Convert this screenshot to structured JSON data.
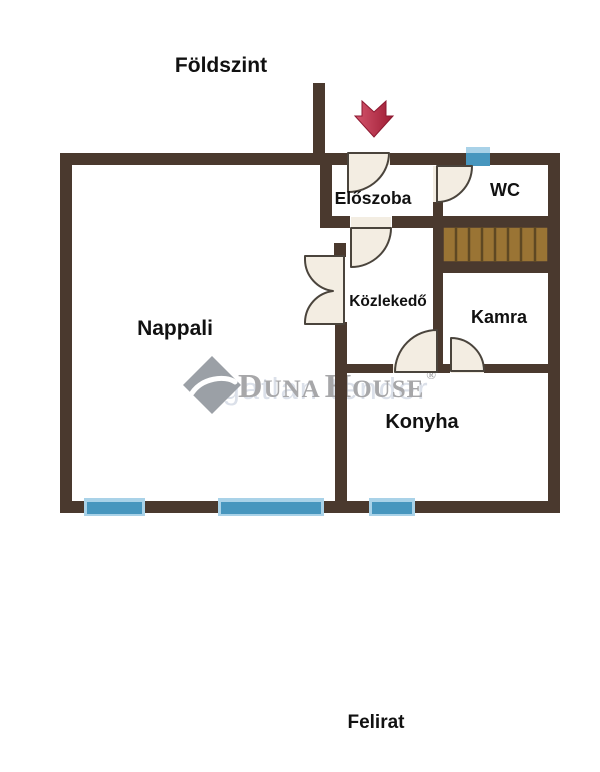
{
  "page": {
    "background": "#ffffff",
    "type": "floor-plan"
  },
  "header": {
    "title": "Földszint"
  },
  "footer": {
    "caption": "Felirat"
  },
  "rooms": {
    "nappali": {
      "label": "Nappali"
    },
    "eloszoba": {
      "label": "Előszoba"
    },
    "wc": {
      "label": "WC"
    },
    "kozlekedo": {
      "label": "Közlekedő"
    },
    "kamra": {
      "label": "Kamra"
    },
    "konyha": {
      "label": "Konyha"
    }
  },
  "features": {
    "stairs": "staircase",
    "entrance_arrow": "entrance-direction-arrow",
    "window_count": 4,
    "door_count": 6
  },
  "watermark": {
    "brand_d": "D",
    "brand_una": "UNA",
    "brand_h": "H",
    "brand_ouse": "OUSE",
    "registered": "®",
    "tagline": "ingatlan tender"
  },
  "colors": {
    "wall": "#4a392e",
    "stairs_fill": "#9a7434",
    "stairs_line": "#5e4823",
    "window_dark": "#4796be",
    "window_light": "#a9d2e8",
    "door_fill": "#f3ede2",
    "door_stroke": "#4a443c",
    "arrow_light": "#d4556d",
    "arrow_dark": "#9e1c34",
    "text": "#111111",
    "watermark_gray": "#a7a7a9",
    "watermark_faint": "#dbe0e9"
  }
}
